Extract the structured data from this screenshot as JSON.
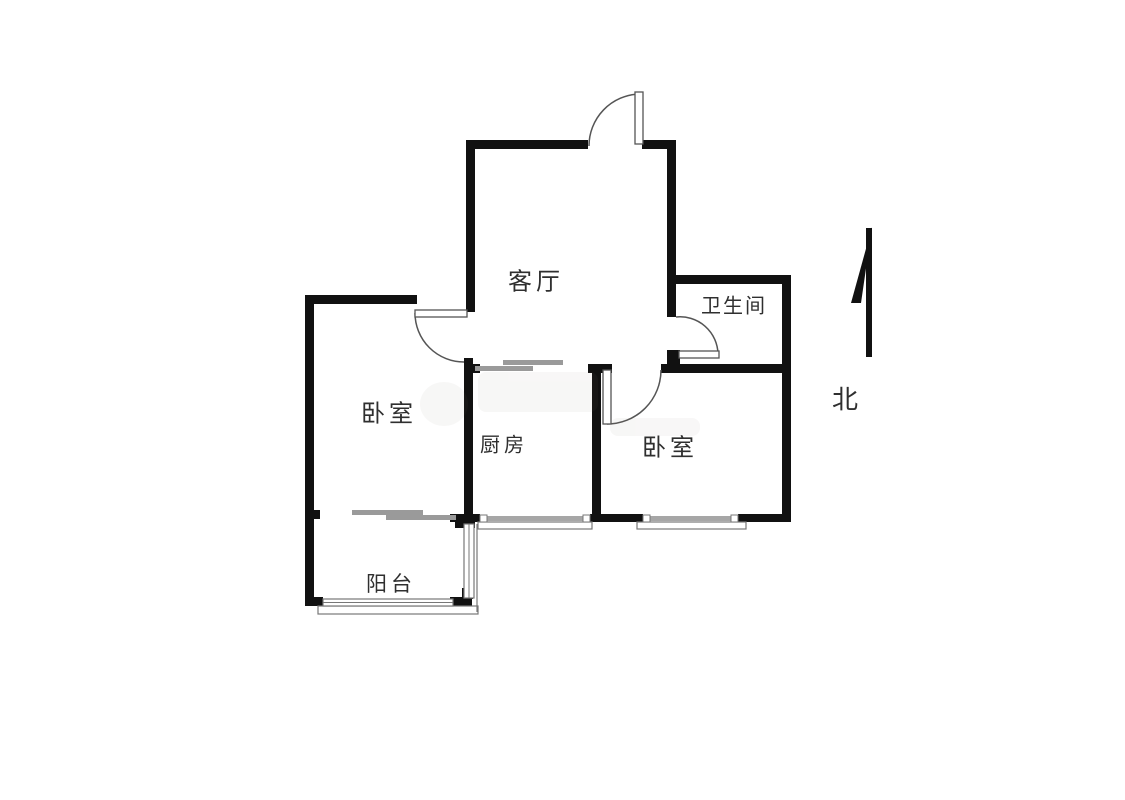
{
  "floorplan": {
    "rooms": [
      {
        "id": "living-room",
        "label": "客厅"
      },
      {
        "id": "bathroom",
        "label": "卫生间"
      },
      {
        "id": "bedroom-left",
        "label": "卧室"
      },
      {
        "id": "kitchen",
        "label": "厨房"
      },
      {
        "id": "bedroom-right",
        "label": "卧室"
      },
      {
        "id": "balcony",
        "label": "阳台"
      }
    ],
    "compass": {
      "label": "北"
    },
    "colors": {
      "wall": "#111111",
      "thin_line": "#555555",
      "sliding_door": "#9a9a9a",
      "window_bar": "#a6a6a6",
      "text": "#2f2f2f",
      "background": "#ffffff"
    }
  }
}
